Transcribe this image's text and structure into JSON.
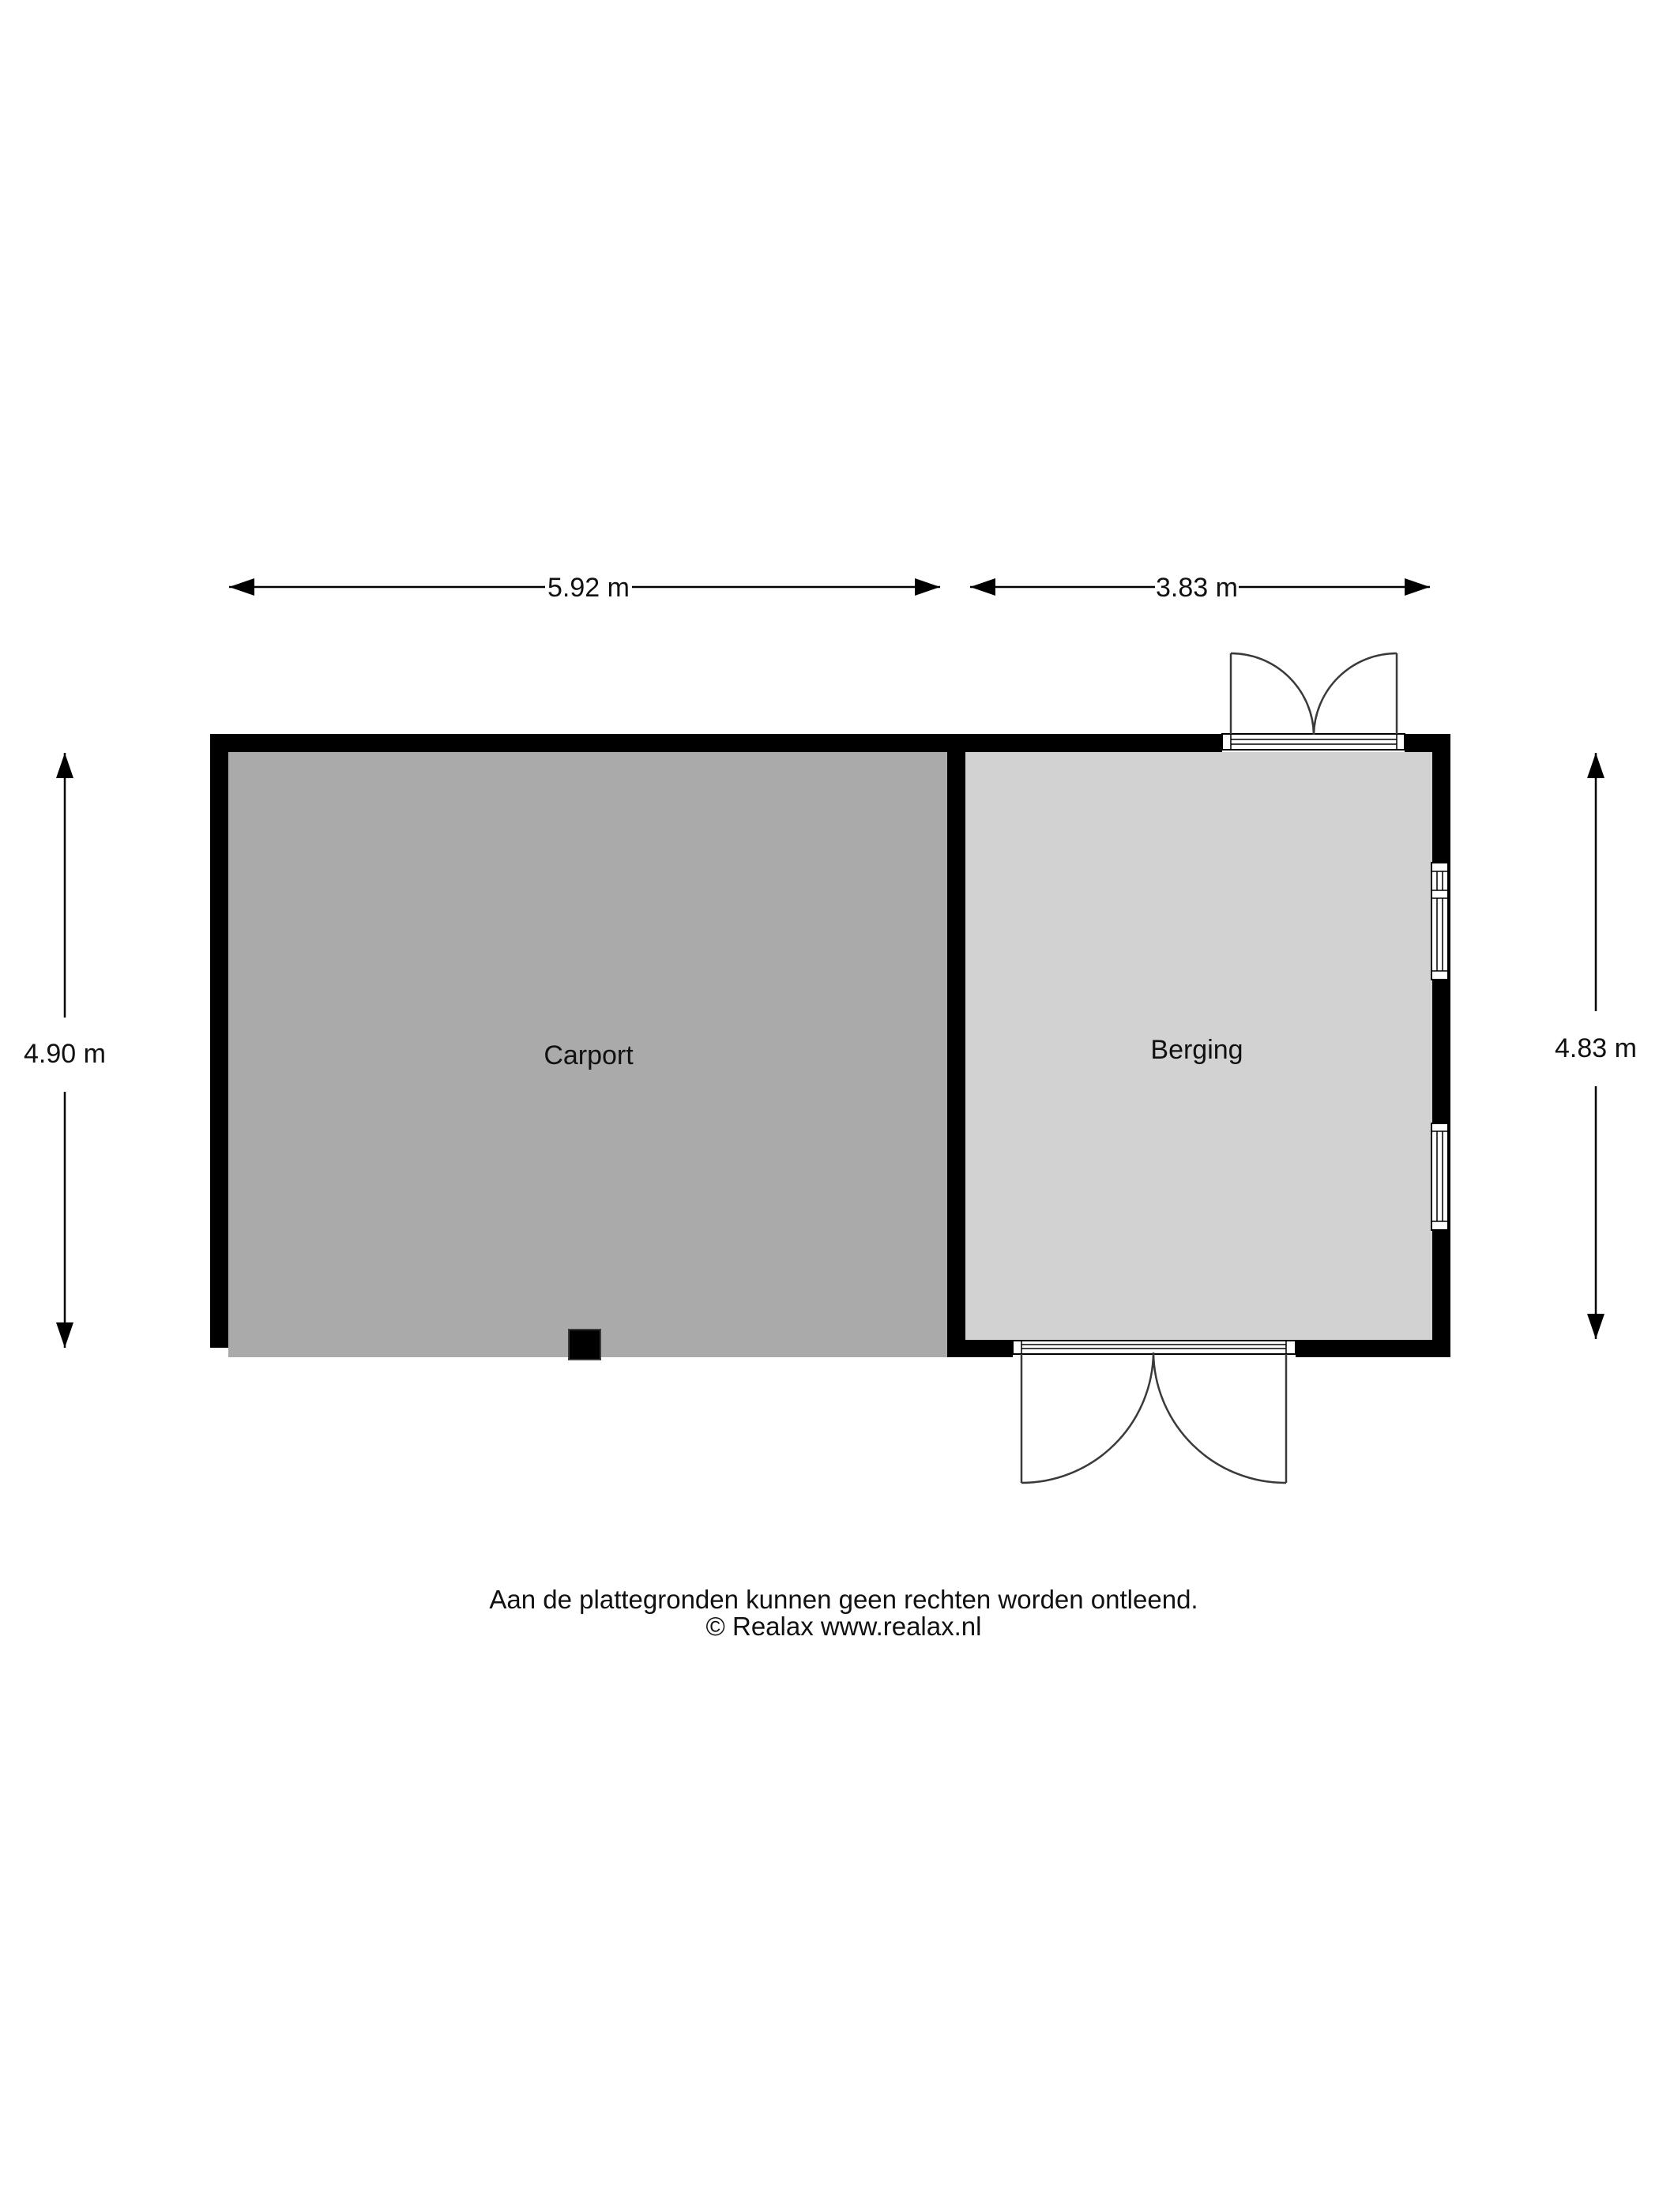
{
  "rooms": {
    "carport": "Carport",
    "berging": "Berging"
  },
  "dimensions": {
    "width_carport": "5.92 m",
    "width_berging": "3.83 m",
    "height_carport": "4.90 m",
    "height_berging": "4.83 m"
  },
  "footer": {
    "disclaimer": "Aan de plattegronden kunnen geen rechten worden ontleend.",
    "copyright": "© Realax www.realax.nl"
  },
  "colors": {
    "wall": "#000000",
    "carport_floor": "#aaaaaa",
    "berging_floor": "#d2d2d2",
    "line": "#000000",
    "door_stroke": "#3a3a3a"
  }
}
